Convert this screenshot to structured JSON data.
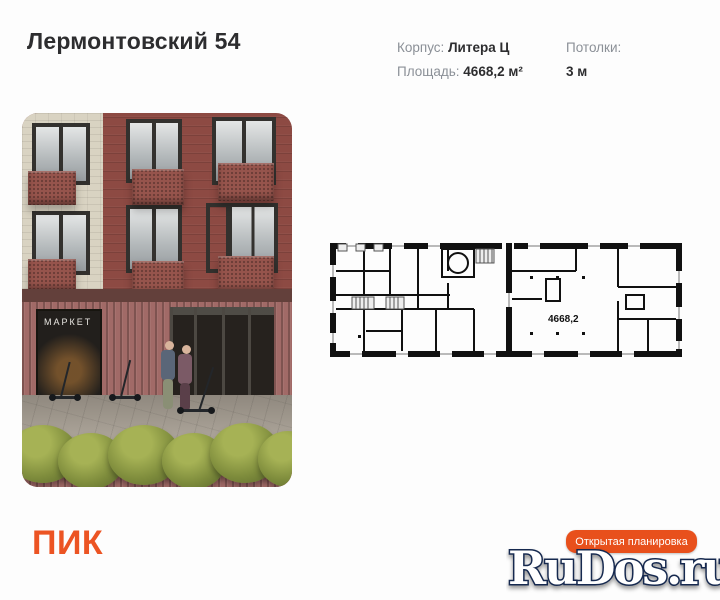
{
  "page": {
    "background": "#fdfdfd"
  },
  "header": {
    "title": "Лермонтовский 54",
    "specs": {
      "building_label": "Корпус:",
      "building_value": "Литера Ц",
      "area_label": "Площадь:",
      "area_value": "4668,2 м²",
      "ceiling_label": "Потолки:",
      "ceiling_value": "3 м"
    }
  },
  "photo": {
    "market_sign": "МАРКЕТ",
    "colors": {
      "brick": "#8d4a43",
      "cream_tile": "#d9d3c2",
      "window_frame": "#33312e",
      "balcony": "#96544c",
      "ribbed_wall": "#a16a67",
      "bush_green": "#7e8c3c"
    }
  },
  "floorplan": {
    "area_label": "4668,2",
    "wall_color": "#111111"
  },
  "footer": {
    "logo_text": "ПИК",
    "logo_color": "#ec5423",
    "button_label": "Открытая планировка",
    "button_color": "#e8501c"
  },
  "watermark": {
    "text": "RuDos.ru",
    "fill": "#ffffff",
    "outline": "#16294f"
  }
}
